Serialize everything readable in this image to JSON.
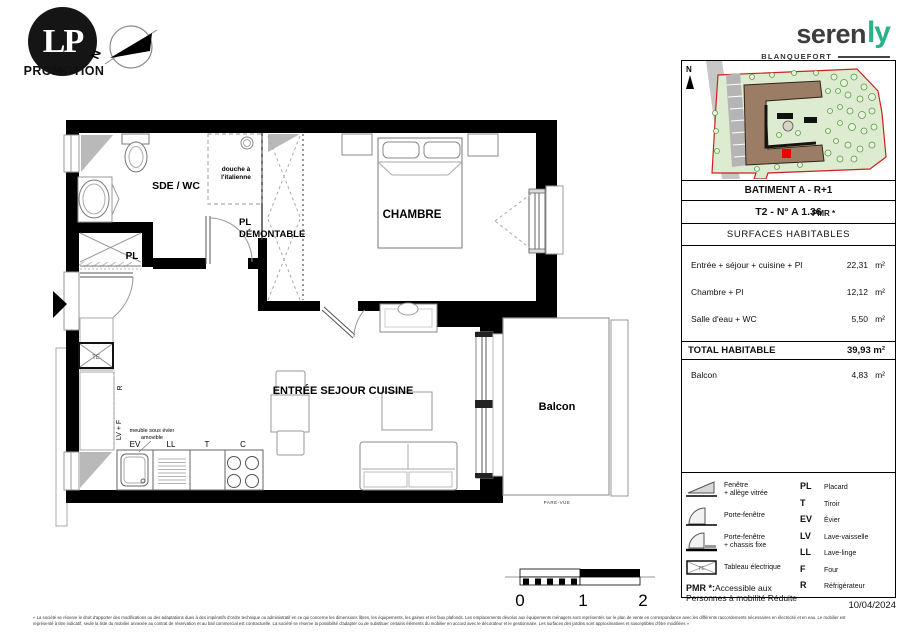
{
  "header": {
    "lp": {
      "monogram": "LP",
      "caption": "PROMOTION"
    },
    "plan_north": "N",
    "serenly": {
      "prefix": "seren",
      "suffix": "ly",
      "city": "BLANQUEFORT"
    }
  },
  "plan": {
    "labels": {
      "sde_wc": "SDE / WC",
      "douche_l1": "douche à",
      "douche_l2": "l'italienne",
      "pl": "PL",
      "pl_dem_l1": "PL",
      "pl_dem_l2": "DÉMONTABLE",
      "chambre": "CHAMBRE",
      "sejour": "ENTRÉE SEJOUR CUISINE",
      "balcon": "Balcon",
      "pare_vue": "PARE-VUE",
      "te": "TE",
      "r": "R",
      "lv_f": "LV + F",
      "meuble_l1": "meuble sous évier",
      "meuble_l2": "amovible",
      "ev": "EV",
      "ll": "LL",
      "t": "T",
      "c": "C"
    },
    "scale": {
      "t0": "0",
      "t1": "1",
      "t2": "2"
    }
  },
  "sidebar": {
    "map_north": "N",
    "batiment": "BATIMENT A - R+1",
    "unit": "T2 - N° A 1.36",
    "pmr_tag": "PMR *",
    "surfaces_title": "SURFACES HABITABLES",
    "surface_rows": [
      {
        "label": "Entrée + séjour + cuisine + Pl",
        "value": "22,31",
        "unit": "m²"
      },
      {
        "label": "Chambre + Pl",
        "value": "12,12",
        "unit": "m²"
      },
      {
        "label": "Salle d'eau + WC",
        "value": "5,50",
        "unit": "m²"
      }
    ],
    "total": {
      "label": "TOTAL HABITABLE",
      "value": "39,93 m²"
    },
    "balcon_row": {
      "label": "Balcon",
      "value": "4,83",
      "unit": "m²"
    },
    "legend": {
      "items": [
        {
          "l1": "Fenêtre",
          "l2": "+ allège vitrée"
        },
        {
          "l1": "Porte-fenêtre",
          "l2": ""
        },
        {
          "l1": "Porte-fenêtre",
          "l2": "+ chassis fixe"
        },
        {
          "l1": "Tableau électrique",
          "l2": ""
        }
      ],
      "pmr_prefix": "PMR *:",
      "pmr_text": "Accessible aux Personnes à mobilité Réduite",
      "abbrs": [
        {
          "abbr": "PL",
          "label": "Placard"
        },
        {
          "abbr": "T",
          "label": "Tiroir"
        },
        {
          "abbr": "EV",
          "label": "Évier"
        },
        {
          "abbr": "LV",
          "label": "Lave-vaisselle"
        },
        {
          "abbr": "LL",
          "label": "Lave-linge"
        },
        {
          "abbr": "F",
          "label": "Four"
        },
        {
          "abbr": "R",
          "label": "Réfrigérateur"
        }
      ]
    },
    "date": "10/04/2024"
  },
  "footer": {
    "line1": "« La société se réserve le droit d'apporter des modifications ou des adaptations dues à des impératifs d'ordre technique ou administratif en ce qui concerne les dimensions libres, les équipements, les gaines et les faux plafonds. Les emplacements dévolus aux équipements ménagers sont représentés sur le plan de vente en correspondance avec les différents raccordements nécessaires en électricité et en eau. Le mobilier est",
    "line2": "représenté à titre indicatif, seule la liste du mobilier annexée au contrat de réservation et au bail commercial est contractuelle. La société se réserve la possibilité d'adapter ou de substituer certains éléments du mobilier en accord avec le décorateur et le gestionnaire. Les surfaces des jardins sont approximatives et susceptibles d'être modifiées »"
  },
  "colors": {
    "brand_green": "#2ab389",
    "site_red": "#cc2020",
    "marker_red": "#ee0000"
  }
}
